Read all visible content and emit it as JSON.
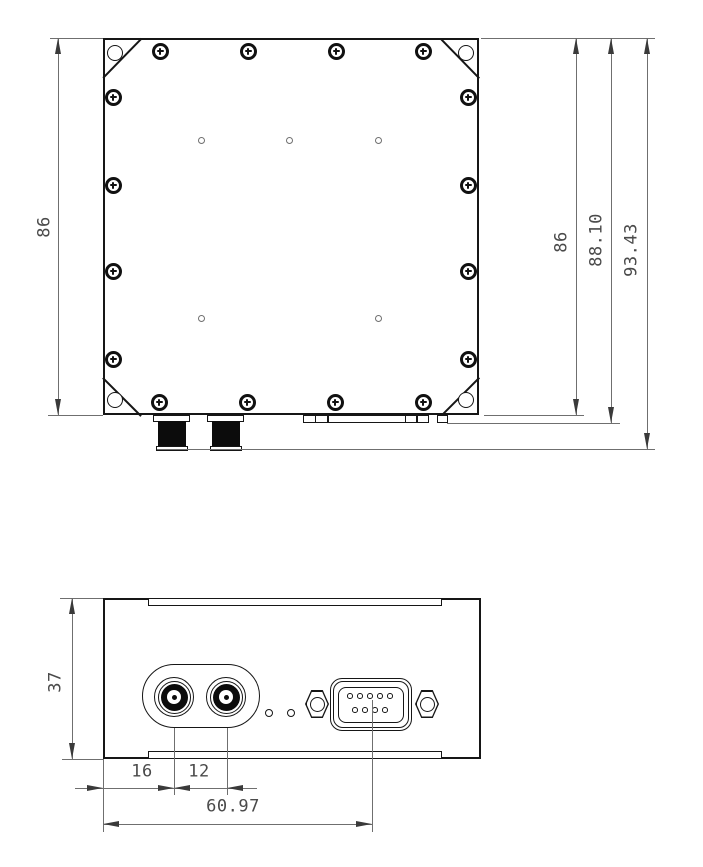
{
  "top_view": {
    "dim_left_height": "86",
    "dim_right_height": "86",
    "dim_right_with_flange": "88.10",
    "dim_right_overall": "93.43"
  },
  "front_view": {
    "dim_panel_height": "37",
    "dim_rf1_from_edge": "16",
    "dim_rf_spacing": "12",
    "dim_db9_from_edge": "60.97"
  }
}
